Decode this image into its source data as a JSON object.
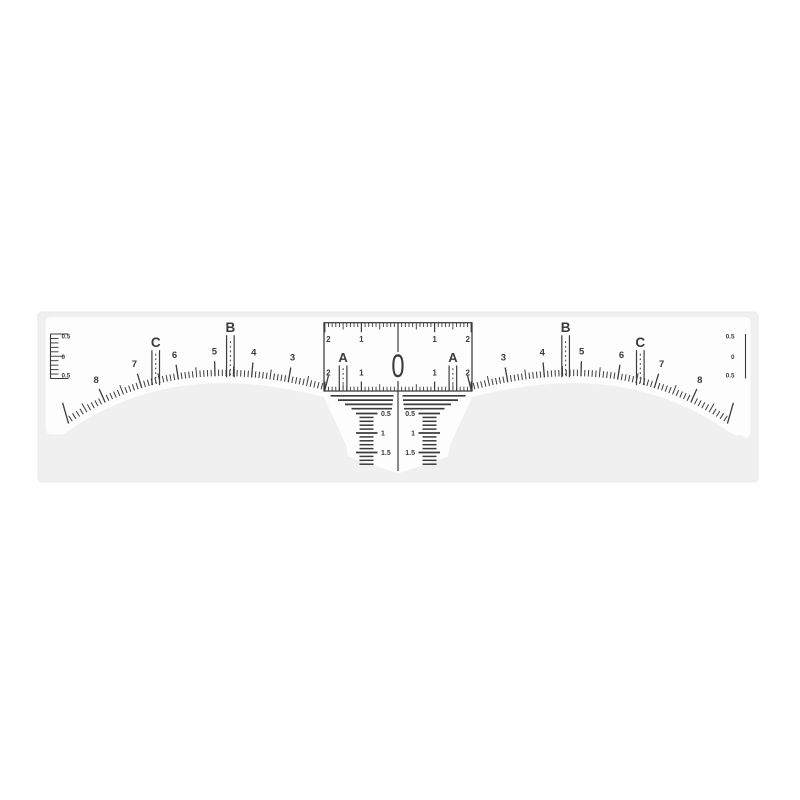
{
  "colors": {
    "page_background": "#ffffff",
    "backing_card": "#f0f0f1",
    "backing_card_edge": "#e9e9ec",
    "sticker": "#fdfdfe",
    "ink": "#3b3b3b"
  },
  "ruler": {
    "center_zero": "0",
    "front_marker_label": "A",
    "front_marker_units": 1.5,
    "arc_letter_markers": [
      {
        "label": "B",
        "units": 4.58
      },
      {
        "label": "C",
        "units": 6.62
      }
    ],
    "arc_number_labels": [
      "3",
      "4",
      "5",
      "6",
      "7",
      "8"
    ],
    "horizontal_scale": {
      "top_labels": [
        {
          "text": "2",
          "u": -2
        },
        {
          "text": "1",
          "u": -1
        },
        {
          "text": "1",
          "u": 1
        },
        {
          "text": "2",
          "u": 2
        }
      ],
      "bottom_labels": [
        {
          "text": "2",
          "u": -2
        },
        {
          "text": "1",
          "u": -1
        },
        {
          "text": "1",
          "u": 1
        },
        {
          "text": "2",
          "u": 2
        }
      ]
    },
    "side_scales": {
      "labels": [
        "0.5",
        "0",
        "0.5"
      ]
    },
    "drop_scale": {
      "labels": [
        {
          "text": "0.5",
          "v": 0.5
        },
        {
          "text": "1",
          "v": 1
        },
        {
          "text": "1.5",
          "v": 1.5
        }
      ]
    }
  }
}
